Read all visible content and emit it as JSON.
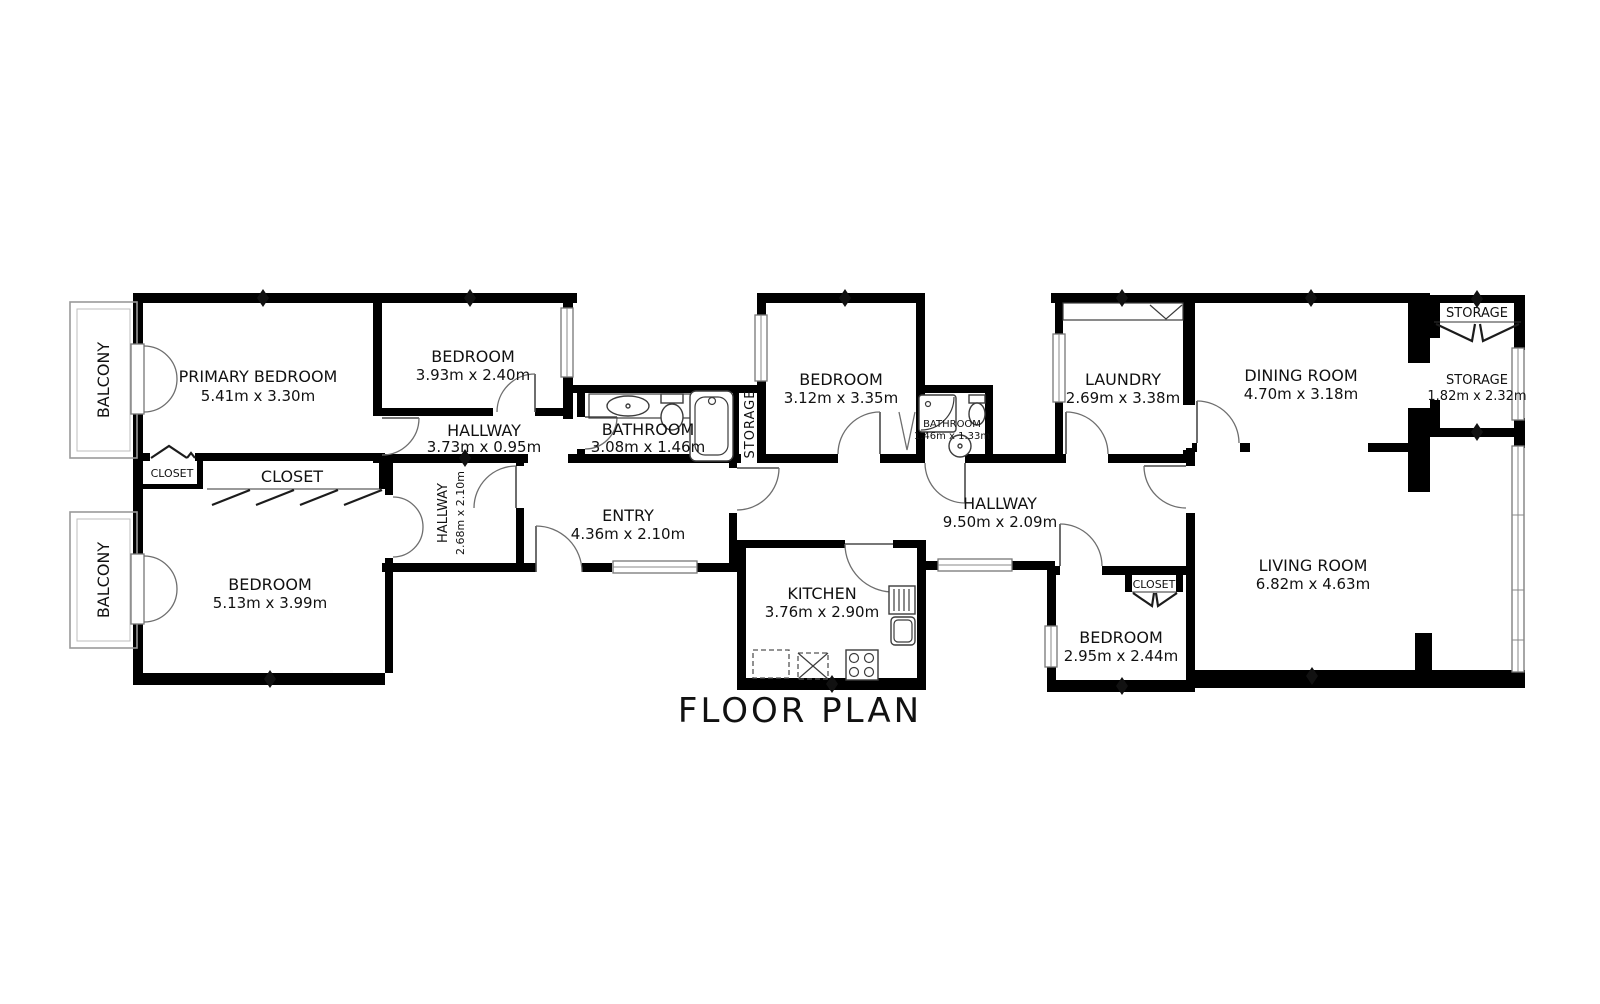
{
  "title": "FLOOR PLAN",
  "palette": {
    "wall": "#000000",
    "background": "#ffffff",
    "thin_line": "#6e6e6e",
    "fixture_line": "#3c3c3c"
  },
  "rooms": {
    "primary_bedroom": {
      "name": "PRIMARY BEDROOM",
      "dims": "5.41m x 3.30m"
    },
    "bedroom_top": {
      "name": "BEDROOM",
      "dims": "3.93m x 2.40m"
    },
    "hallway_top": {
      "name": "HALLWAY",
      "dims": "3.73m x 0.95m"
    },
    "bathroom_main": {
      "name": "BATHROOM",
      "dims": "3.08m x 1.46m"
    },
    "storage_mid": {
      "name": "STORAGE"
    },
    "bedroom_mid": {
      "name": "BEDROOM",
      "dims": "3.12m x 3.35m"
    },
    "bathroom_small": {
      "name": "BATHROOM",
      "dims": "1.46m x 1.33m"
    },
    "laundry": {
      "name": "LAUNDRY",
      "dims": "2.69m x 3.38m"
    },
    "dining_room": {
      "name": "DINING ROOM",
      "dims": "4.70m x 3.18m"
    },
    "storage_niche": {
      "name": "STORAGE"
    },
    "storage_right": {
      "name": "STORAGE",
      "dims": "1.82m x 2.32m"
    },
    "balcony_top": {
      "name": "BALCONY"
    },
    "balcony_bottom": {
      "name": "BALCONY"
    },
    "closet_small": {
      "name": "CLOSET"
    },
    "closet_wide": {
      "name": "CLOSET"
    },
    "bedroom_left": {
      "name": "BEDROOM",
      "dims": "5.13m x 3.99m"
    },
    "hallway_vert": {
      "name": "HALLWAY",
      "dims": "2.68m x 2.10m"
    },
    "entry": {
      "name": "ENTRY",
      "dims": "4.36m x 2.10m"
    },
    "hallway_main": {
      "name": "HALLWAY",
      "dims": "9.50m x 2.09m"
    },
    "kitchen": {
      "name": "KITCHEN",
      "dims": "3.76m x 2.90m"
    },
    "bedroom_small": {
      "name": "BEDROOM",
      "dims": "2.95m x 2.44m"
    },
    "closet_right": {
      "name": "CLOSET"
    },
    "living_room": {
      "name": "LIVING ROOM",
      "dims": "6.82m x 4.63m"
    }
  }
}
